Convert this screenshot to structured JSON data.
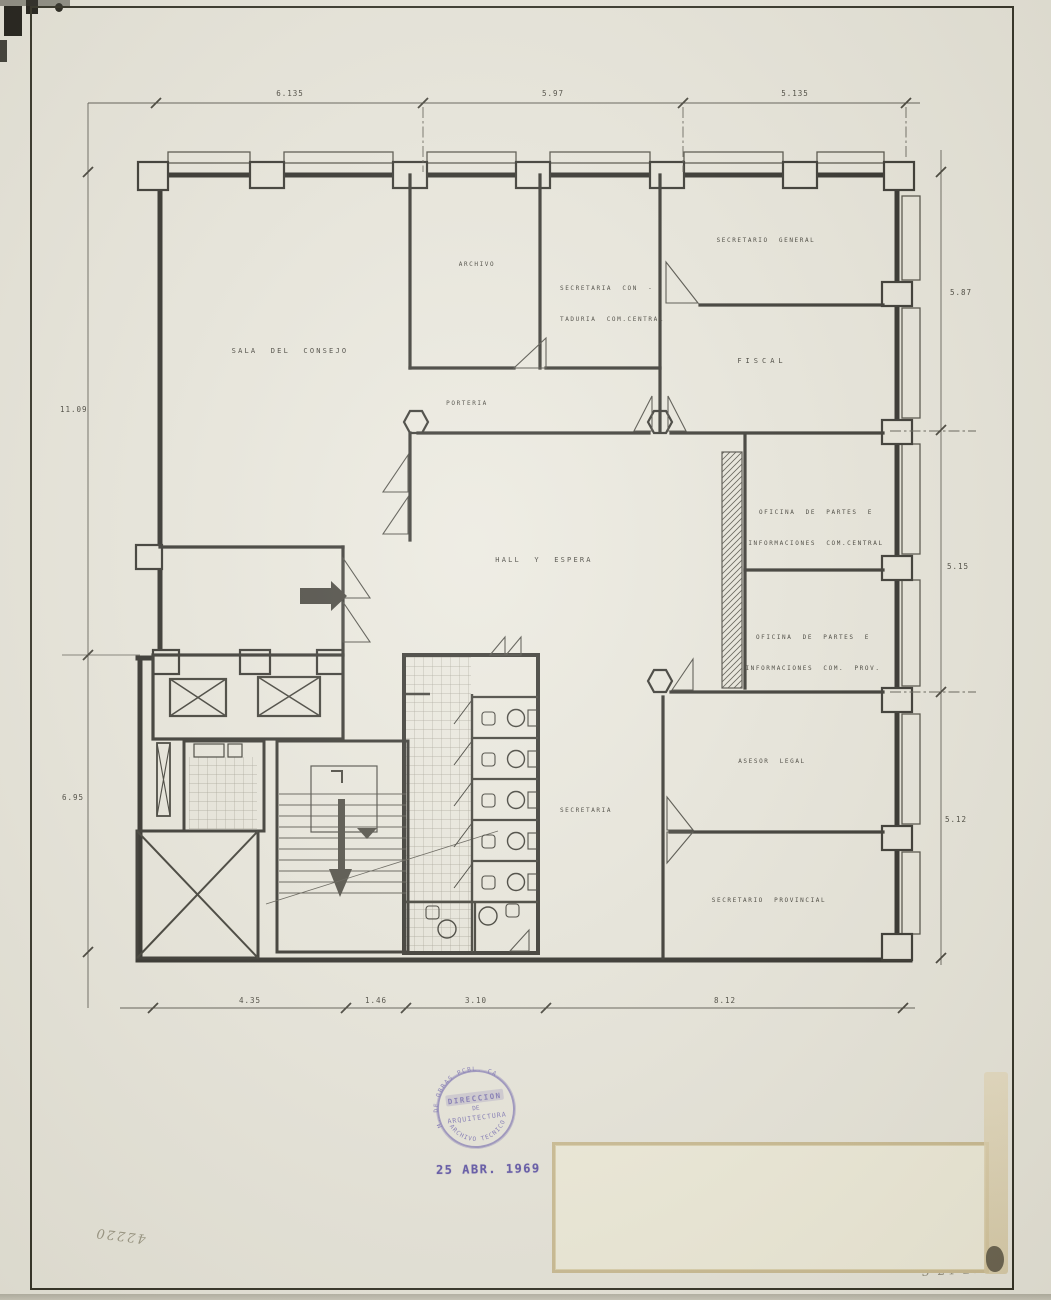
{
  "drawing": {
    "rooms": {
      "sala_del_consejo": "SALA DEL CONSEJO",
      "archivo": "ARCHIVO",
      "secretaria_contaduria_l1": "SECRETARIA CON -",
      "secretaria_contaduria_l2": "TADURIA COM.CENTRAL",
      "secretario_general": "SECRETARIO GENERAL",
      "fiscal": "FISCAL",
      "porteria": "PORTERIA",
      "hall_espera": "HALL Y ESPERA",
      "oficina_partes_central_l1": "OFICINA DE PARTES E",
      "oficina_partes_central_l2": "INFORMACIONES COM.CENTRAL",
      "oficina_partes_prov_l1": "OFICINA DE PARTES E",
      "oficina_partes_prov_l2": "INFORMACIONES COM. PROV.",
      "asesor_legal": "ASESOR LEGAL",
      "secretaria": "SECRETARIA",
      "secretario_provincial": "SECRETARIO PROVINCIAL"
    },
    "dimensions": {
      "top": [
        "6.135",
        "5.97",
        "5.135"
      ],
      "left": [
        "11.09",
        "6.95"
      ],
      "right": [
        "5.87",
        "5.15",
        "5.12"
      ],
      "bottom": [
        "4.35",
        "1.46",
        "3.10",
        "8.12"
      ]
    },
    "stamp": {
      "arc_top": "M. DE OBRAS PCBL. CA.",
      "line1": "DIRECCION",
      "line2": "DE",
      "line3": "ARQUITECTURA",
      "arc_bottom": "ARCHIVO TECNICO",
      "ink_color": "#6a5fae"
    },
    "date_stamp": "25 ABR. 1969",
    "handwriting": {
      "inventory_number": "42220",
      "file_code": "3-24-27"
    },
    "colors": {
      "paper": "#eae8dd",
      "line": "#23221d",
      "stamp_ink": "#6a5fae"
    }
  }
}
